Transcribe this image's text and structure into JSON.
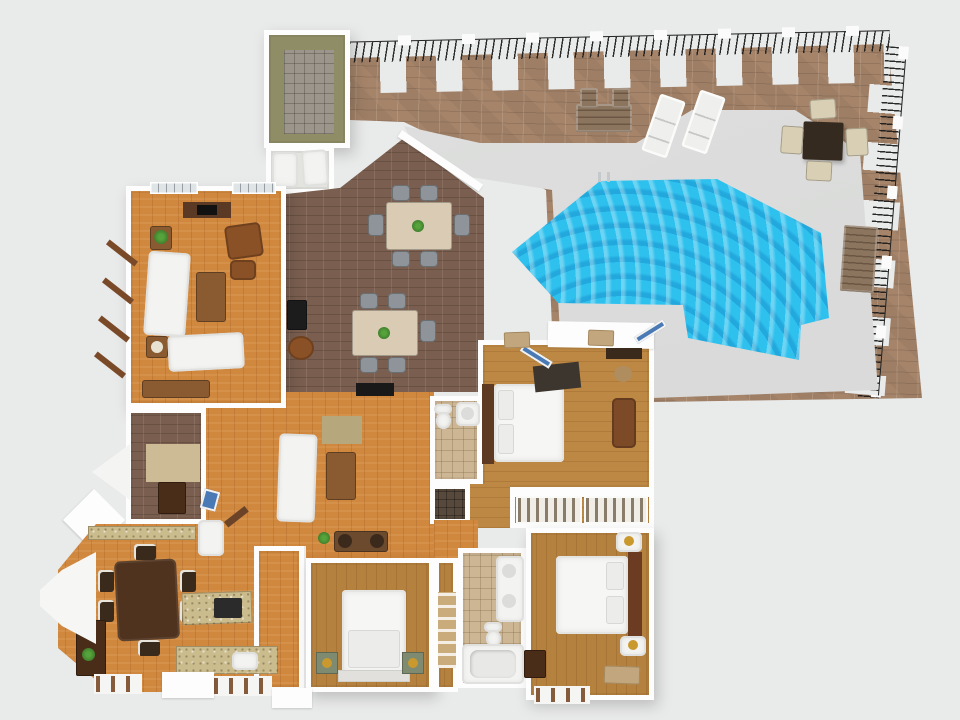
{
  "scene": {
    "description": "3D rendered top-down floor plan of a single-storey house with brick pool patio",
    "view": "top-down 3D render, no visible text",
    "canvas": {
      "width": 960,
      "height": 720
    }
  },
  "palette": {
    "bg": "#e9eaea",
    "wall": "#fdfdfd",
    "patio_brick": "#9e7f66",
    "interior_brick": "#7a5f50",
    "deck": "#d9dad9",
    "pool": "#2fc1ee",
    "wood_orange": "#d0873e",
    "wood_gold": "#bd8843",
    "wood_medium": "#b5813e",
    "tile_tan": "#cdb694",
    "tile_dark": "#57493c",
    "granite": "#cbbc8e",
    "olive_floor": "#8f8d66",
    "storage_tile": "#9b958b",
    "sofa_white": "#f3f3f1",
    "bed_white": "#f6f6f4",
    "leather_brown": "#8a5126",
    "table_brown": "#8a5a30",
    "walnut": "#4f331f",
    "dark_wood": "#4a2d18",
    "chair_gray": "#8e9499",
    "cream": "#d9cfb5",
    "outdoor_table": "#352a20",
    "bench_wood": "#8b755f",
    "fence": "#1f1f1f",
    "headboard": "#5f3a22",
    "green_stand": "#7e8b70",
    "plant_green": "#3f7d2c",
    "glass_blue": "#4a7ab5",
    "rug_dark": "#3c362f",
    "rug_tan": "#cdbb95",
    "rug_olive": "#b7a77c",
    "mat_tan": "#c2a77e",
    "gold": "#c9992e",
    "black": "#191919"
  },
  "outdoor": {
    "patio": {
      "label": "brick paver patio",
      "floor": "brick"
    },
    "deck": {
      "label": "concrete pool deck",
      "floor": "concrete"
    },
    "pool": {
      "label": "free-form swimming pool",
      "water": "#2fc1ee"
    },
    "fence": {
      "label": "black metal rail fence with brick pillars and white post caps",
      "sides": [
        "top",
        "right"
      ]
    },
    "furniture": [
      "outdoor-sofa-set",
      "lounge-chair",
      "lounge-chair",
      "patio-dining-table",
      "patio-chair",
      "patio-chair",
      "patio-chair",
      "patio-chair",
      "garden-bench",
      "pool-ladder",
      "doormat",
      "doormat"
    ]
  },
  "rooms": [
    {
      "id": "utility-room",
      "name": "storage / utility room",
      "floor": "olive with gray tile storage bay",
      "furniture": [
        "tile-storage-bay"
      ]
    },
    {
      "id": "laundry",
      "name": "laundry nook",
      "floor": "white",
      "furniture": [
        "washer",
        "dryer"
      ]
    },
    {
      "id": "dining-room",
      "name": "dining / family room",
      "floor": "interior brick",
      "furniture": [
        "dining-table-6-chairs",
        "breakfast-table-5-chairs",
        "corner-fireplace",
        "swivel-chair",
        "wall-tv"
      ]
    },
    {
      "id": "left-living",
      "name": "living room",
      "floor": "orange hardwood",
      "furniture": [
        "fireplace-media",
        "side-table-plant",
        "sofa",
        "coffee-table",
        "armchair",
        "ottoman",
        "lamp-table",
        "loveseat",
        "console"
      ]
    },
    {
      "id": "alcove",
      "name": "den nook with bay window",
      "floor": "interior brick",
      "furniture": [
        "area-rug",
        "console",
        "blue-decor"
      ]
    },
    {
      "id": "central-living",
      "name": "family room",
      "floor": "orange hardwood",
      "furniture": [
        "area-rug",
        "sofa",
        "coffee-table",
        "speaker-console",
        "plant",
        "pantry-cabinet",
        "wall-tv"
      ]
    },
    {
      "id": "kitchen",
      "name": "kitchen / breakfast room",
      "floor": "orange hardwood",
      "furniture": [
        "walnut-dining-table-6-chairs",
        "island-cooktop",
        "sink-counter",
        "counter",
        "hutch",
        "bay-window"
      ]
    },
    {
      "id": "foyer",
      "name": "entry foyer",
      "floor": "orange hardwood",
      "furniture": [
        "front-stoop"
      ]
    },
    {
      "id": "master-bedroom",
      "name": "bedroom 1 (master)",
      "floor": "golden hardwood",
      "furniture": [
        "double-bed",
        "area-rug",
        "basket",
        "bench-chest",
        "french-doors",
        "wall-console"
      ]
    },
    {
      "id": "closet",
      "name": "walk-in closet",
      "floor": "golden hardwood",
      "furniture": [
        "clothes-rail",
        "clothes-rail"
      ]
    },
    {
      "id": "bath1",
      "name": "bathroom 1",
      "floor": "tan tile",
      "furniture": [
        "toilet",
        "vanity-sink"
      ]
    },
    {
      "id": "shower",
      "name": "walk-in shower",
      "floor": "dark tile",
      "furniture": []
    },
    {
      "id": "bath2",
      "name": "bathroom 2",
      "floor": "tan tile",
      "furniture": [
        "double-vanity",
        "toilet",
        "bathtub"
      ]
    },
    {
      "id": "bedroom2",
      "name": "bedroom 2",
      "floor": "hardwood",
      "furniture": [
        "double-bed",
        "nightstand",
        "nightstand",
        "cabinet",
        "doormat"
      ]
    },
    {
      "id": "bedroom3",
      "name": "bedroom 3",
      "floor": "hardwood",
      "furniture": [
        "double-bed",
        "green-nightstand-lamp",
        "green-nightstand-lamp"
      ]
    },
    {
      "id": "hallway",
      "name": "hallway",
      "floor": "hardwood",
      "furniture": [
        "linen-shelves"
      ]
    }
  ]
}
